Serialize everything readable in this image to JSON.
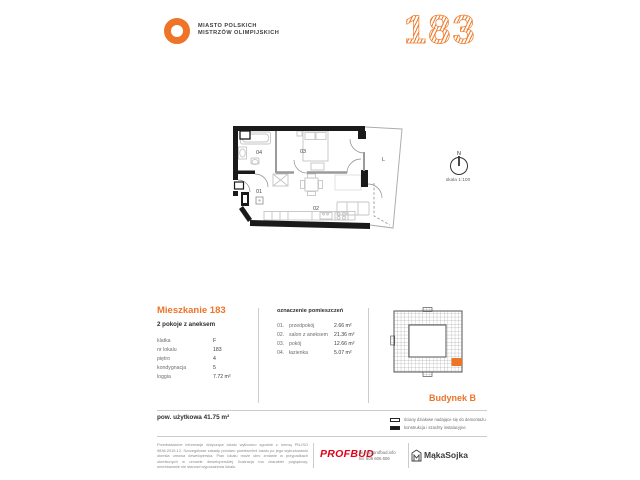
{
  "colors": {
    "accent": "#EE7428",
    "profbud_red": "#E2001A"
  },
  "header": {
    "brand_line1": "MIASTO POLSKICH",
    "brand_line2": "MISTRZÓW OLIMPIJSKICH",
    "unit_number": "183"
  },
  "plan": {
    "labels": {
      "hall": "01",
      "living": "02",
      "room": "03",
      "bath": "04",
      "loggia": "L"
    },
    "compass_n": "N",
    "scale": "skala 1:100"
  },
  "details": {
    "title": "Mieszkanie 183",
    "subtitle": "2 pokoje z aneksem",
    "rows": [
      {
        "label": "klatka",
        "value": "F"
      },
      {
        "label": "nr lokalu",
        "value": "183"
      },
      {
        "label": "piętro",
        "value": "4"
      },
      {
        "label": "kondygnacja",
        "value": "5"
      },
      {
        "label": "loggia",
        "value": "7.72 m²"
      }
    ]
  },
  "rooms": {
    "heading": "oznaczenie pomieszczeń",
    "items": [
      {
        "no": "01.",
        "name": "przedpokój",
        "area": "2.66 m²"
      },
      {
        "no": "02.",
        "name": "salon z aneksem",
        "area": "21.36 m²"
      },
      {
        "no": "03.",
        "name": "pokój",
        "area": "12.66 m²"
      },
      {
        "no": "04.",
        "name": "łazienka",
        "area": "5.07 m²"
      }
    ]
  },
  "building": {
    "label": "Budynek B"
  },
  "summary": {
    "usable_area": "pow. użytkowa 41.75 m²"
  },
  "legend": {
    "items": [
      {
        "text": "ściany działowe nadające się do demontażu"
      },
      {
        "text": "konstrukcja i szachty instalacyjne"
      }
    ]
  },
  "footer": {
    "disclaimer": "Przedstawione informacje dotyczące lokalu wyliczono zgodnie z normą PN-ISO 9836:2015-12. Szczegółowe zasady pomiaru powierzchni lokalu po jego wybudowaniu określa umowa deweloperska. Plan lokalu może ulec zmianie w przypadkach określonych w umowie deweloperskiej. Ilustracja ma charakter poglądowy, umeblowanie nie stanowi wyposażenia lokalu.",
    "brand": "PROFBUD",
    "email": "biuro@profbud.info",
    "phone": "tel. 605 606 606",
    "studio": "MąkaSojka"
  }
}
